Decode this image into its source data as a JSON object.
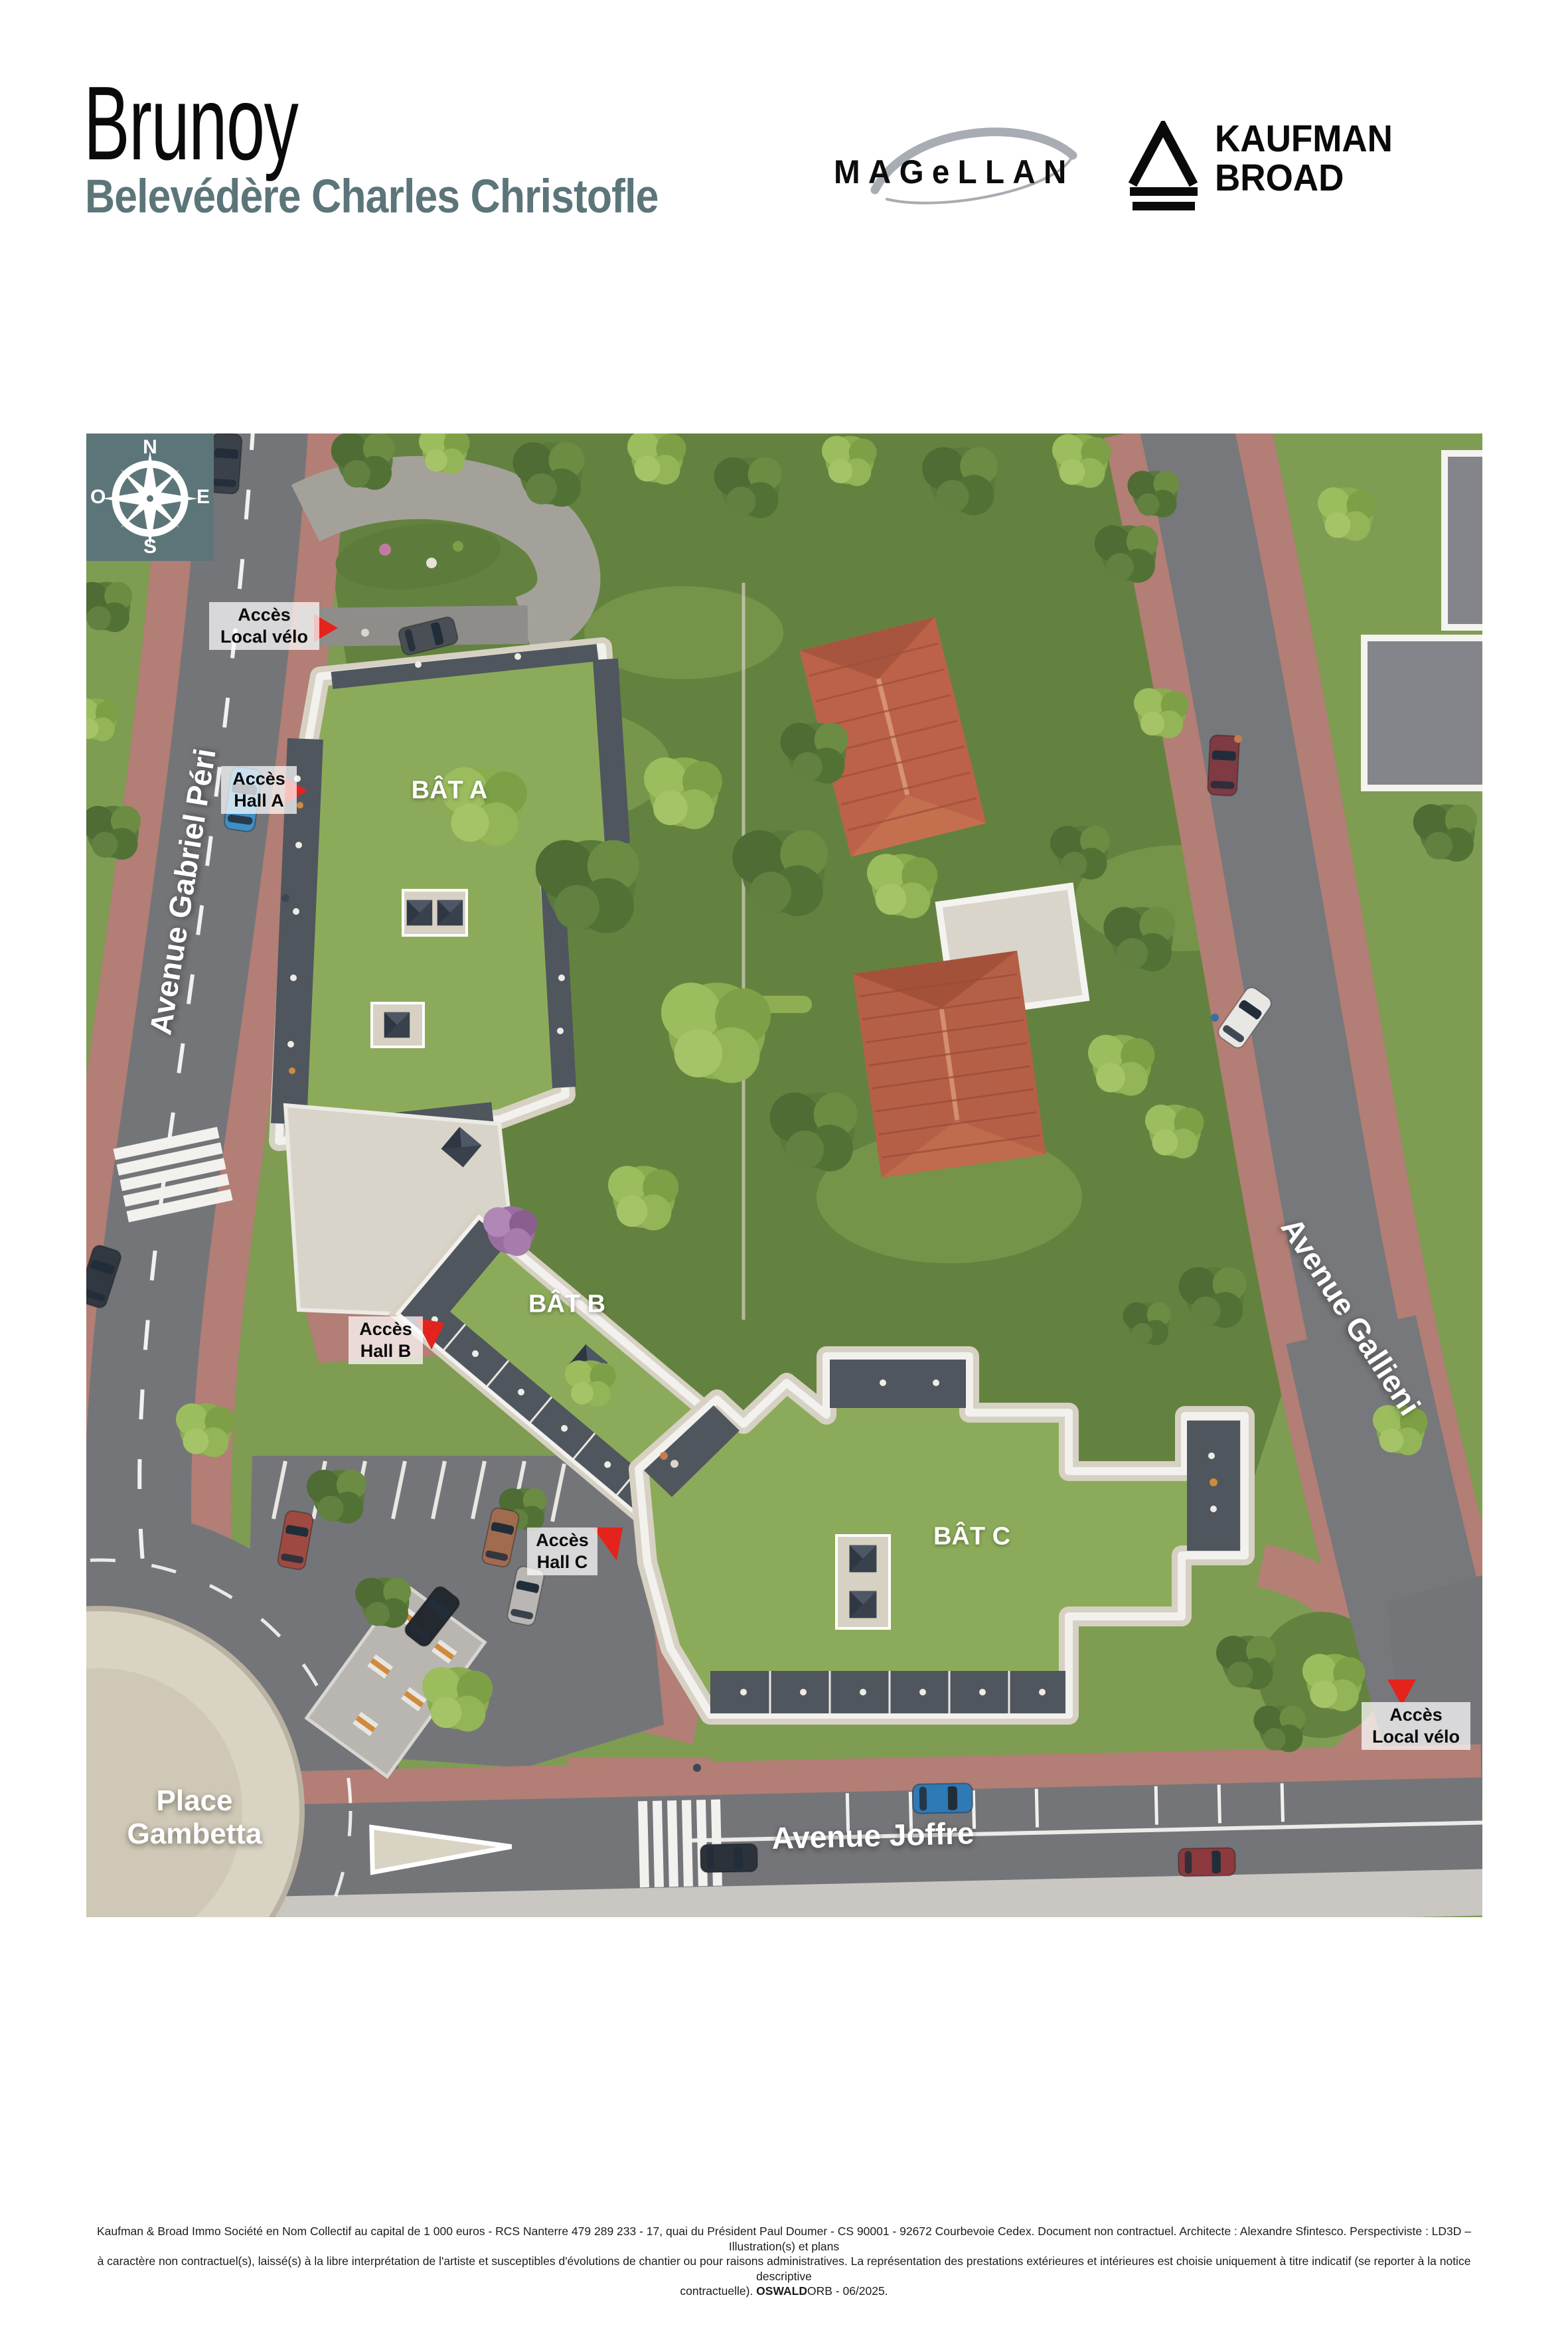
{
  "header": {
    "city": "Brunoy",
    "program": "Belevédère Charles Christofle"
  },
  "logos": {
    "magellan": "MAGeLLAN",
    "kaufman_line1": "KAUFMAN",
    "kaufman_line2": "BROAD"
  },
  "compass": {
    "north": "N",
    "east": "E",
    "south": "S",
    "west": "O"
  },
  "map": {
    "buildings": {
      "bat_a": "BÂT A",
      "bat_b": "BÂT B",
      "bat_c": "BÂT C"
    },
    "streets": {
      "gabriel_peri": "Avenue Gabriel Péri",
      "gallieni": "Avenue Gallieni",
      "joffre": "Avenue Joffre",
      "gambetta_line1": "Place",
      "gambetta_line2": "Gambetta"
    },
    "access": {
      "velo_top_line1": "Accès",
      "velo_top_line2": "Local vélo",
      "hall_a_line1": "Accès",
      "hall_a_line2": "Hall A",
      "hall_b_line1": "Accès",
      "hall_b_line2": "Hall B",
      "hall_c_line1": "Accès",
      "hall_c_line2": "Hall C",
      "velo_right_line1": "Accès",
      "velo_right_line2": "Local vélo"
    }
  },
  "colors": {
    "brand_teal": "#5c7579",
    "accent_red": "#e3231c",
    "roof_green": "#8cab5a",
    "road_gray": "#747579",
    "sidewalk_rose": "#b27e75"
  },
  "footer": {
    "line1": "Kaufman & Broad Immo Société en Nom Collectif au capital de 1 000 euros - RCS Nanterre 479 289 233 - 17, quai du Président Paul Doumer - CS 90001 - 92672 Courbevoie Cedex. Document non contractuel. Architecte : Alexandre Sfintesco. Perspectiviste : LD3D – Illustration(s) et plans",
    "line2": "à caractère non contractuel(s), laissé(s) à la libre interprétation de l'artiste et susceptibles d'évolutions de chantier ou pour raisons administratives. La représentation des prestations extérieures et intérieures est choisie uniquement à titre indicatif (se reporter à la notice descriptive",
    "line3_prefix": "contractuelle). ",
    "line3_brand": "OSWALD",
    "line3_suffix": "ORB - 06/2025."
  }
}
